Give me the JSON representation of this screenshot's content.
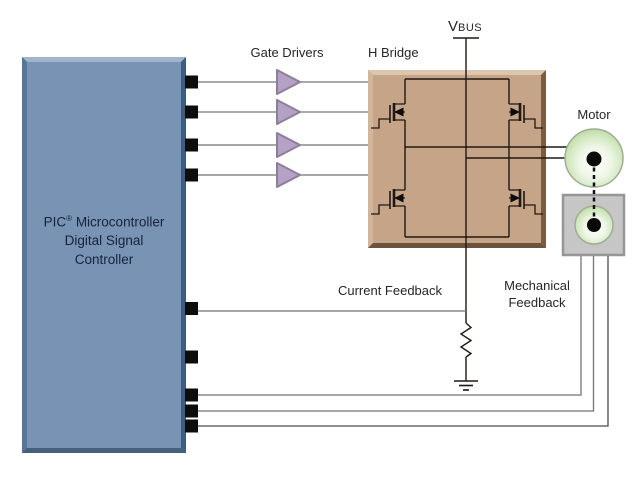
{
  "diagram": {
    "labels": {
      "gate_drivers": "Gate Drivers",
      "h_bridge": "H Bridge",
      "vbus_main": "V",
      "vbus_sub": "BUS",
      "motor": "Motor",
      "current_feedback": "Current Feedback",
      "mechanical_feedback_line1": "Mechanical",
      "mechanical_feedback_line2": "Feedback",
      "controller_line1_prefix": "PIC",
      "controller_line1_reg": "®",
      "controller_line1_suffix": " Microcontroller",
      "controller_line2": "Digital Signal",
      "controller_line3": "Controller"
    },
    "icons": {
      "gate_driver_symbol": "buffer-triangle",
      "switch_symbol": "n-channel-mosfet",
      "shunt_symbol": "resistor-zigzag",
      "ground_symbol": "earth-ground",
      "motor_symbol": "shaft-circle",
      "sensor_symbol": "position-sensor-box"
    },
    "colors": {
      "controller_fill": "#7893b3",
      "controller_bevel_light": "#a0b4ca",
      "controller_bevel_dark": "#44607c",
      "controller_text": "#17233c",
      "hbridge_fill": "#c5a488",
      "hbridge_bevel_light": "#dcc6ae",
      "hbridge_bevel_dark": "#7a5c45",
      "driver_fill": "#b4a2c4",
      "driver_stroke": "#8c7e9c",
      "motor_green": "#b9dba4",
      "sensor_fill": "#c6c6c6",
      "sensor_border": "#969696",
      "wire_gray": "#757575",
      "circuit_black": "#201812",
      "pin_black": "#0d0d0d"
    }
  }
}
